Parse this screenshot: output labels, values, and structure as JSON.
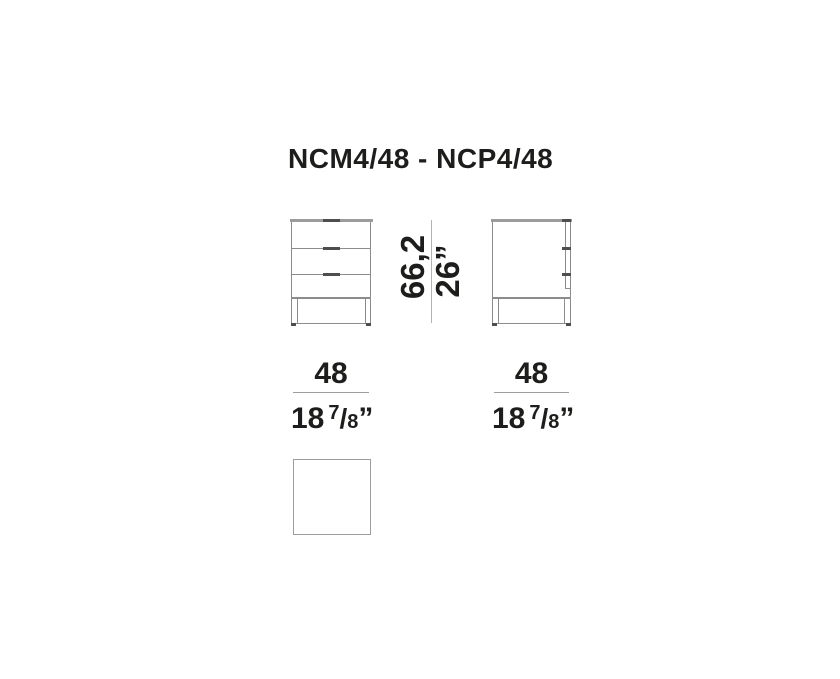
{
  "title": "NCM4/48 - NCP4/48",
  "colors": {
    "text": "#1d1d1b",
    "line_gray": "#8c8c8c",
    "surface_gray": "#9c9c9c",
    "handle_dark": "#4e4e4e",
    "dim_line": "#b3b3b3"
  },
  "views": {
    "front": {
      "drawer_count": 3
    },
    "side": {
      "drawer_count": 3
    },
    "top": {}
  },
  "dims": {
    "height_cm": "66,2",
    "height_in": "26”",
    "front": {
      "cm": "48",
      "in_whole": "18",
      "in_num": "7",
      "in_slash": "/",
      "in_den": "8",
      "in_quote": "”"
    },
    "side": {
      "cm": "48",
      "in_whole": "18",
      "in_num": "7",
      "in_slash": "/",
      "in_den": "8",
      "in_quote": "”"
    }
  }
}
